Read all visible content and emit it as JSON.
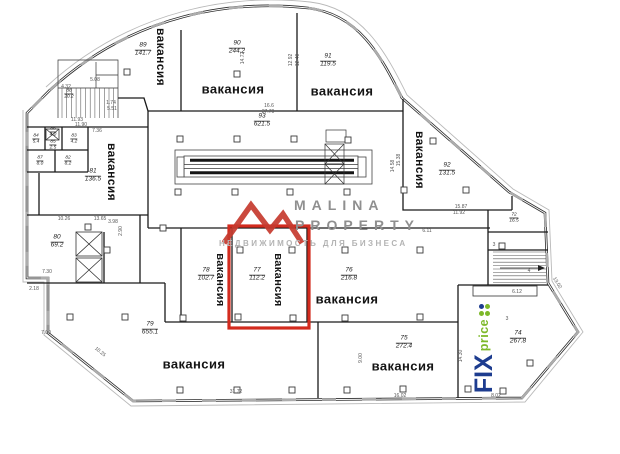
{
  "watermark": {
    "line1": "MALINA",
    "line2": "PROPERTY",
    "tagline": "НЕДВИЖИМОСТЬ ДЛЯ БИЗНЕСА",
    "accent": "#c5392e",
    "text_color": "#8f8f8f",
    "tagline_color": "#b3b3b3"
  },
  "highlight": {
    "room": "77",
    "color": "#d32b1e"
  },
  "fixprice": {
    "word1": "FIX",
    "word2": "price",
    "navy": "#1d3c8f",
    "green": "#7db829",
    "dot_colors": [
      "#7db829",
      "#1d3c8f",
      "#7db829",
      "#7db829"
    ]
  },
  "vacancy_word": "вакансия",
  "rooms": [
    {
      "number": "89",
      "area": "141.7",
      "label": "вакансия",
      "orient": "v",
      "lx": 161,
      "ly": 57,
      "fs": 12,
      "nx": 143,
      "ny": 50
    },
    {
      "number": "90",
      "area": "244.2",
      "label": "вакансия",
      "orient": "h",
      "lx": 233,
      "ly": 89,
      "fs": 13,
      "nx": 237,
      "ny": 48
    },
    {
      "number": "91",
      "area": "119.5",
      "label": "вакансия",
      "orient": "h",
      "lx": 342,
      "ly": 91,
      "fs": 13,
      "nx": 328,
      "ny": 61
    },
    {
      "number": "92",
      "area": "131.5",
      "label": "вакансия",
      "orient": "v",
      "lx": 420,
      "ly": 160,
      "fs": 12,
      "nx": 447,
      "ny": 170
    },
    {
      "number": "93",
      "area": "621.5",
      "nx": 262,
      "ny": 121
    },
    {
      "number": "81",
      "area": "136.5",
      "label": "вакансия",
      "orient": "v",
      "lx": 112,
      "ly": 172,
      "fs": 12,
      "nx": 93,
      "ny": 176
    },
    {
      "number": "80",
      "area": "69.2",
      "nx": 57,
      "ny": 242
    },
    {
      "number": "88",
      "area": "20.2",
      "nx": 69,
      "ny": 94,
      "small": true
    },
    {
      "number": "78",
      "area": "102.7",
      "label": "вакансия",
      "orient": "v",
      "lx": 220,
      "ly": 280,
      "fs": 11,
      "nx": 206,
      "ny": 275
    },
    {
      "number": "77",
      "area": "112.2",
      "label": "вакансия",
      "orient": "v",
      "lx": 278,
      "ly": 280,
      "fs": 11,
      "nx": 257,
      "ny": 275
    },
    {
      "number": "76",
      "area": "216.8",
      "label": "вакансия",
      "orient": "h",
      "lx": 347,
      "ly": 299,
      "fs": 13,
      "nx": 349,
      "ny": 275
    },
    {
      "number": "79",
      "area": "655.1",
      "label": "вакансия",
      "orient": "h",
      "lx": 194,
      "ly": 364,
      "fs": 13,
      "nx": 150,
      "ny": 329
    },
    {
      "number": "75",
      "area": "272.4",
      "label": "вакансия",
      "orient": "h",
      "lx": 403,
      "ly": 366,
      "fs": 13,
      "nx": 404,
      "ny": 343
    },
    {
      "number": "74",
      "area": "267.8",
      "nx": 518,
      "ny": 338
    },
    {
      "number": "72",
      "area": "16.5",
      "nx": 514,
      "ny": 218,
      "small": true
    },
    {
      "number": "82",
      "area": "8.2",
      "nx": 68,
      "ny": 161,
      "small": true
    },
    {
      "number": "83",
      "area": "4.2",
      "nx": 74,
      "ny": 139,
      "small": true
    },
    {
      "number": "84",
      "area": "5.4",
      "nx": 36,
      "ny": 139,
      "small": true
    },
    {
      "number": "85",
      "area": "2.5",
      "nx": 53,
      "ny": 145,
      "small": true
    },
    {
      "number": "86",
      "area": "4.0",
      "nx": 53,
      "ny": 132,
      "small": true
    },
    {
      "number": "87",
      "area": "8.0",
      "nx": 40,
      "ny": 161,
      "small": true
    }
  ],
  "annotations": [
    {
      "t": "11.90",
      "x": 81,
      "y": 125,
      "r": 0
    },
    {
      "t": "7.36",
      "x": 97,
      "y": 131,
      "r": 0
    },
    {
      "t": "5.08",
      "x": 95,
      "y": 80,
      "r": 0
    },
    {
      "t": "4.32",
      "x": 66,
      "y": 87,
      "r": 0
    },
    {
      "t": "11.93",
      "x": 77,
      "y": 120,
      "r": 0
    },
    {
      "t": "1.74",
      "x": 111,
      "y": 103,
      "r": 0
    },
    {
      "t": "5.51",
      "x": 112,
      "y": 109,
      "r": 0
    },
    {
      "t": "10.26",
      "x": 64,
      "y": 219,
      "r": 0
    },
    {
      "t": "13.65",
      "x": 100,
      "y": 219,
      "r": 0
    },
    {
      "t": "3.98",
      "x": 113,
      "y": 222,
      "r": 0
    },
    {
      "t": "2.90",
      "x": 121,
      "y": 231,
      "r": -90
    },
    {
      "t": "7.30",
      "x": 47,
      "y": 272,
      "r": 0
    },
    {
      "t": "2.18",
      "x": 34,
      "y": 289,
      "r": 0
    },
    {
      "t": "7.00",
      "x": 46,
      "y": 333,
      "r": 0
    },
    {
      "t": "10.25",
      "x": 100,
      "y": 352,
      "r": 39
    },
    {
      "t": "31.72",
      "x": 236,
      "y": 392,
      "r": 0
    },
    {
      "t": "16.6",
      "x": 269,
      "y": 106,
      "r": 0
    },
    {
      "t": "37.70",
      "x": 268,
      "y": 112,
      "r": 0
    },
    {
      "t": "14.72",
      "x": 243,
      "y": 58,
      "r": -90
    },
    {
      "t": "12.92",
      "x": 291,
      "y": 60,
      "r": -90
    },
    {
      "t": "12.40",
      "x": 298,
      "y": 60,
      "r": -90
    },
    {
      "t": "15.38",
      "x": 399,
      "y": 160,
      "r": -90
    },
    {
      "t": "14.58",
      "x": 393,
      "y": 166,
      "r": -90
    },
    {
      "t": "15.87",
      "x": 461,
      "y": 207,
      "r": 0
    },
    {
      "t": "11.92",
      "x": 459,
      "y": 213,
      "r": 0
    },
    {
      "t": "9.00",
      "x": 361,
      "y": 358,
      "r": -90
    },
    {
      "t": "16.02",
      "x": 400,
      "y": 396,
      "r": 0
    },
    {
      "t": "8.02",
      "x": 496,
      "y": 396,
      "r": 0
    },
    {
      "t": "6.12",
      "x": 517,
      "y": 292,
      "r": 0
    },
    {
      "t": "13.02",
      "x": 557,
      "y": 283,
      "r": 58
    },
    {
      "t": "6.11",
      "x": 427,
      "y": 231,
      "r": 0
    },
    {
      "t": "14.30",
      "x": 461,
      "y": 356,
      "r": -90
    },
    {
      "t": "3",
      "x": 494,
      "y": 245,
      "r": 0
    },
    {
      "t": "4",
      "x": 529,
      "y": 271,
      "r": 0
    },
    {
      "t": "3",
      "x": 507,
      "y": 319,
      "r": 0
    }
  ],
  "plan": {
    "columns": [
      [
        127,
        72
      ],
      [
        237,
        74
      ],
      [
        180,
        139
      ],
      [
        237,
        139
      ],
      [
        294,
        139
      ],
      [
        348,
        140
      ],
      [
        433,
        141
      ],
      [
        178,
        192
      ],
      [
        235,
        192
      ],
      [
        290,
        192
      ],
      [
        347,
        192
      ],
      [
        404,
        190
      ],
      [
        466,
        190
      ],
      [
        88,
        227
      ],
      [
        163,
        228
      ],
      [
        107,
        250
      ],
      [
        240,
        250
      ],
      [
        292,
        250
      ],
      [
        345,
        250
      ],
      [
        420,
        250
      ],
      [
        502,
        246
      ],
      [
        70,
        317
      ],
      [
        125,
        317
      ],
      [
        183,
        318
      ],
      [
        238,
        317
      ],
      [
        293,
        318
      ],
      [
        345,
        318
      ],
      [
        420,
        317
      ],
      [
        180,
        390
      ],
      [
        237,
        390
      ],
      [
        292,
        390
      ],
      [
        347,
        390
      ],
      [
        403,
        389
      ],
      [
        468,
        389
      ],
      [
        503,
        391
      ],
      [
        530,
        363
      ]
    ],
    "stairs": [
      {
        "dir": "v",
        "from": 62,
        "to": 118,
        "a": 88,
        "b": 118,
        "step": 4.7
      },
      {
        "dir": "h",
        "from": 252,
        "to": 283,
        "a": 493,
        "b": 546,
        "step": 3.4
      }
    ]
  }
}
